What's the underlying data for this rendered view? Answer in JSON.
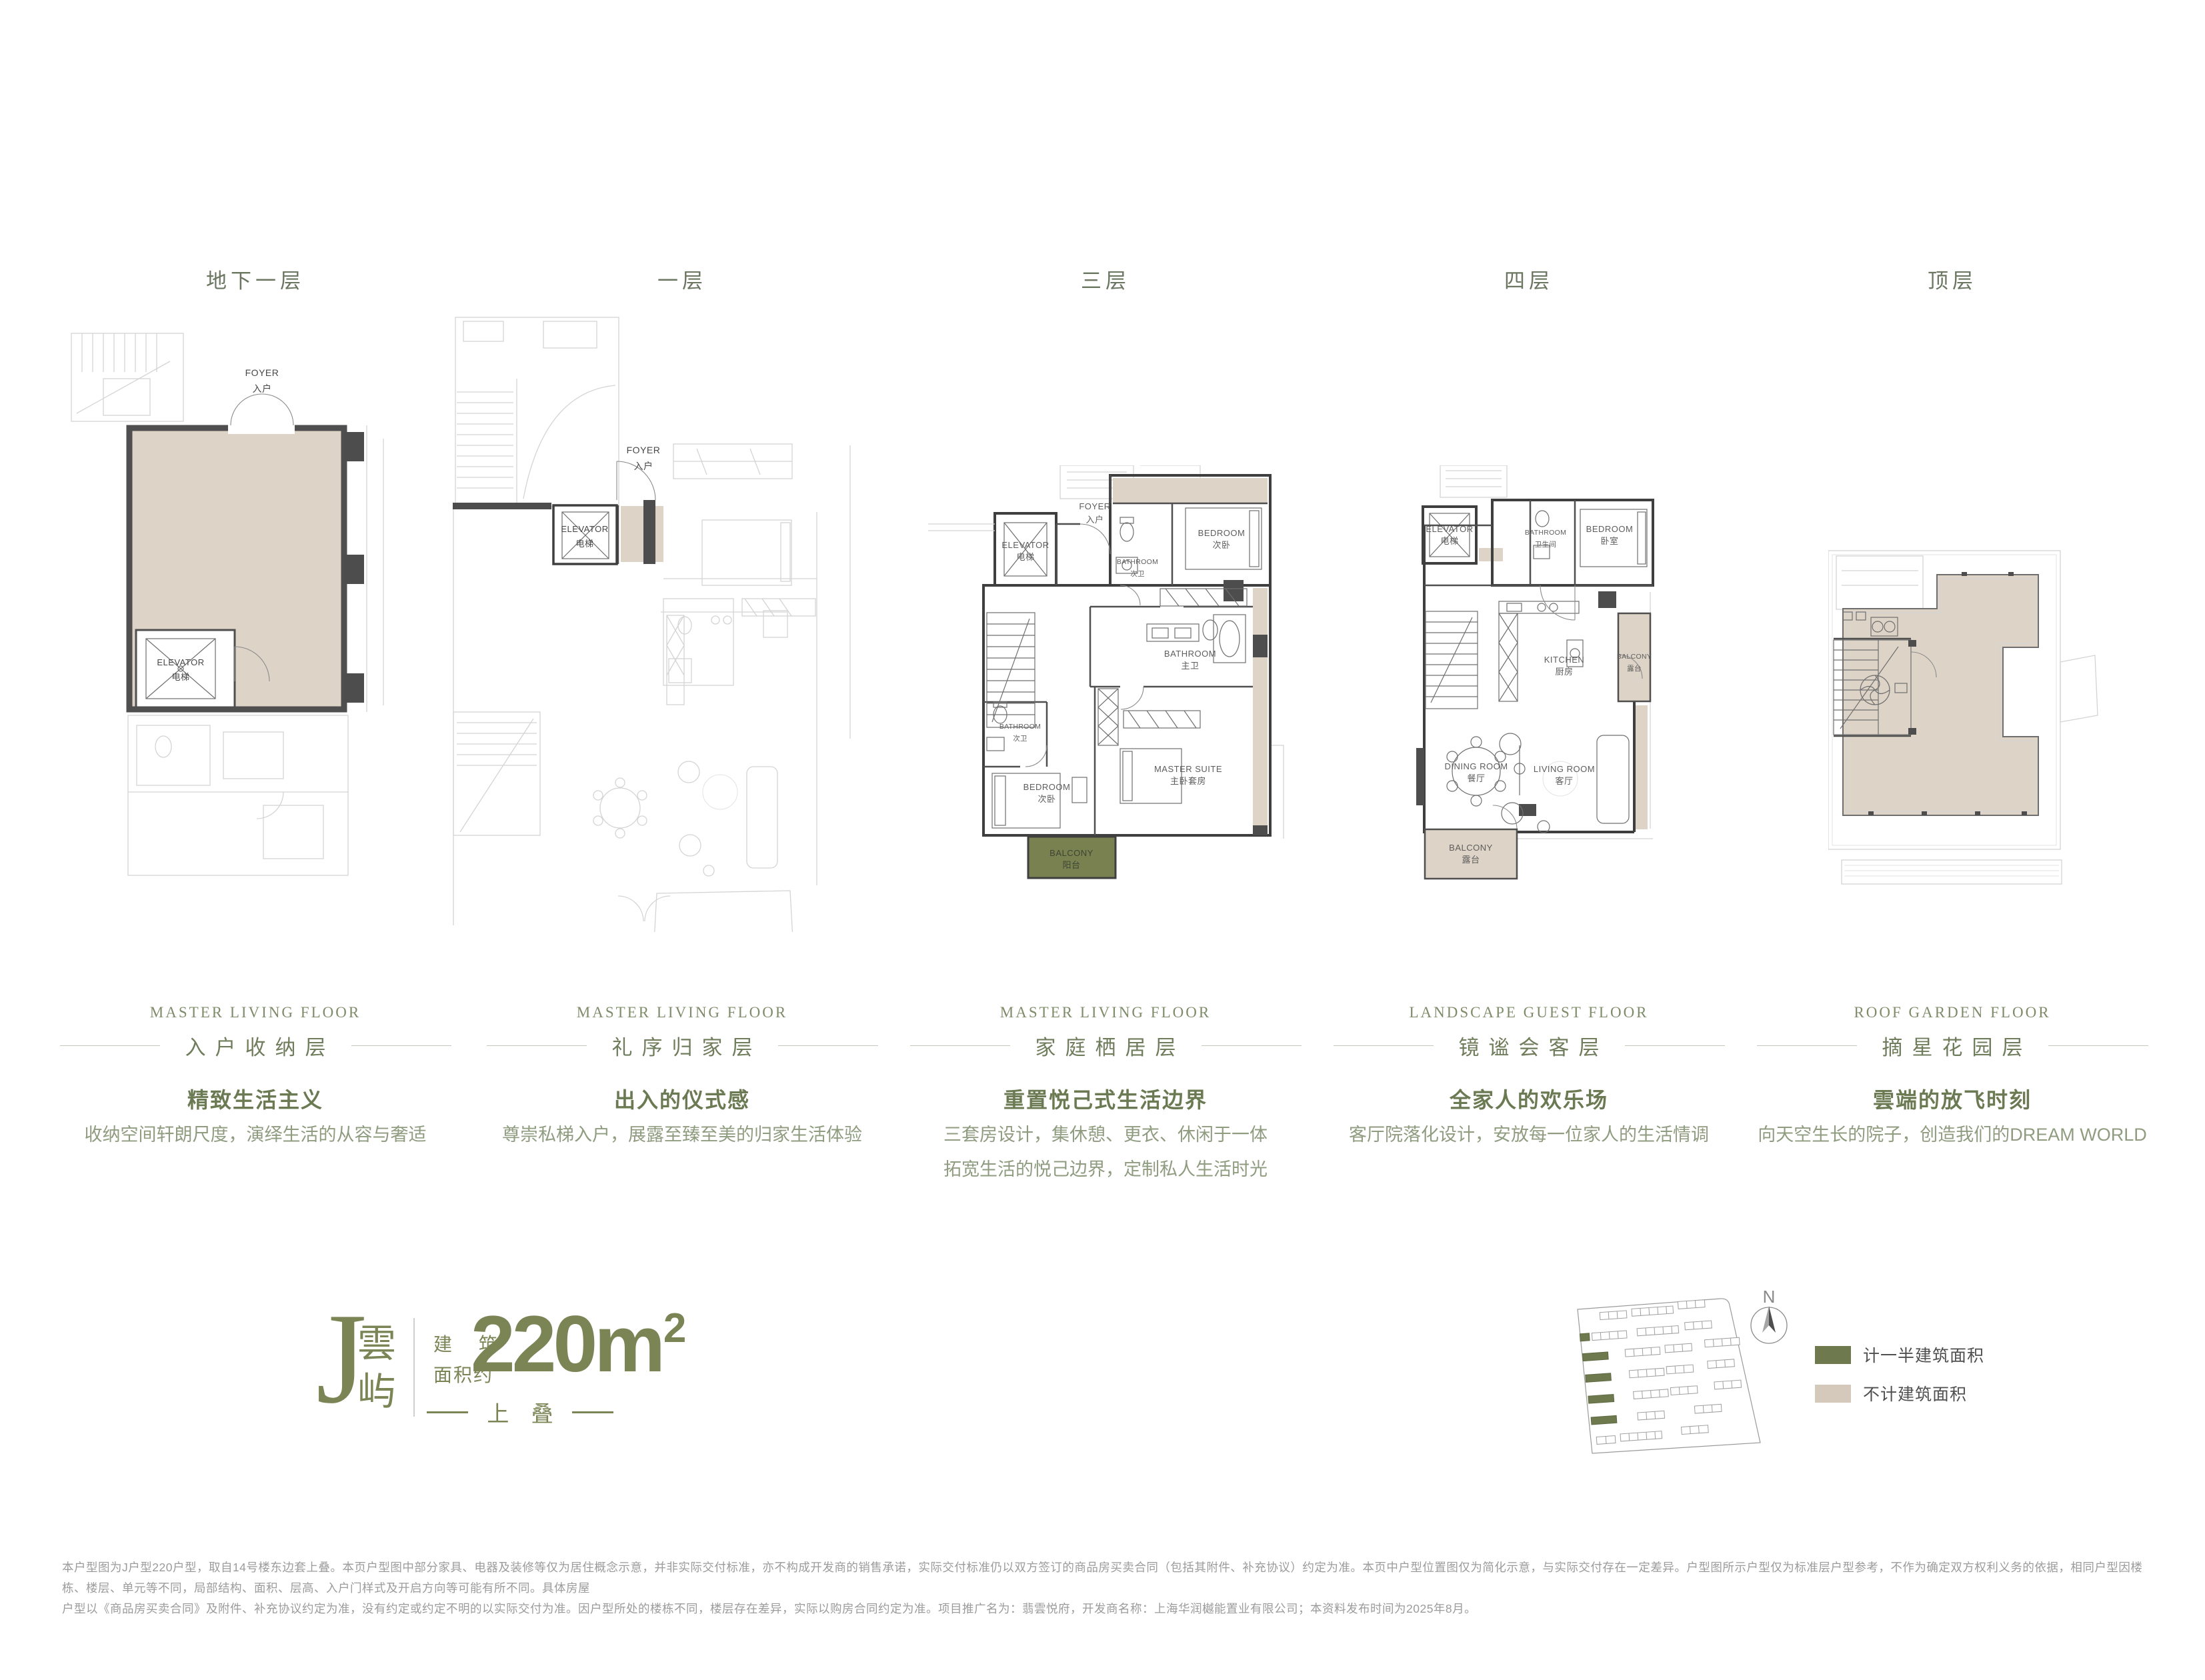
{
  "floors": [
    {
      "label": "地下一层",
      "english_title": "MASTER LIVING FLOOR",
      "chinese_title": "入户收纳层",
      "headline": "精致生活主义",
      "description": [
        "收纳空间轩朗尺度，演绎生活的从容与奢适"
      ]
    },
    {
      "label": "一层",
      "english_title": "MASTER LIVING FLOOR",
      "chinese_title": "礼序归家层",
      "headline": "出入的仪式感",
      "description": [
        "尊崇私梯入户，展露至臻至美的归家生活体验"
      ]
    },
    {
      "label": "三层",
      "english_title": "MASTER LIVING FLOOR",
      "chinese_title": "家庭栖居层",
      "headline": "重置悦己式生活边界",
      "description": [
        "三套房设计，集休憩、更衣、休闲于一体",
        "拓宽生活的悦己边界，定制私人生活时光"
      ]
    },
    {
      "label": "四层",
      "english_title": "LANDSCAPE GUEST FLOOR",
      "chinese_title": "镜谧会客层",
      "headline": "全家人的欢乐场",
      "description": [
        "客厅院落化设计，安放每一位家人的生活情调"
      ]
    },
    {
      "label": "顶层",
      "english_title": "ROOF GARDEN FLOOR",
      "chinese_title": "摘星花园层",
      "headline": "雲端的放飞时刻",
      "description": [
        "向天空生长的院子，创造我们的DREAM WORLD"
      ]
    }
  ],
  "plans": {
    "b1": {
      "foyer": "FOYER",
      "foyer_cn": "入户",
      "elevator": "ELEVATOR",
      "elevator_cn": "电梯"
    },
    "f1": {
      "foyer": "FOYER",
      "foyer_cn": "入户",
      "elevator": "ELEVATOR",
      "elevator_cn": "电梯"
    },
    "f3": {
      "elevator": "ELEVATOR",
      "elevator_cn": "电梯",
      "foyer": "FOYER",
      "foyer_cn": "入户",
      "bath_top": "BATHROOM",
      "bath_top_cn": "次卫",
      "bed_top": "BEDROOM",
      "bed_top_cn": "次卧",
      "bath_master": "BATHROOM",
      "bath_master_cn": "主卫",
      "bath_low": "BATHROOM",
      "bath_low_cn": "次卫",
      "bed_low": "BEDROOM",
      "bed_low_cn": "次卧",
      "master": "MASTER SUITE",
      "master_cn": "主卧套房",
      "balcony": "BALCONY",
      "balcony_cn": "阳台"
    },
    "f4": {
      "elevator": "ELEVATOR",
      "elevator_cn": "电梯",
      "bath": "BATHROOM",
      "bath_cn": "卫生间",
      "bed": "BEDROOM",
      "bed_cn": "卧室",
      "kitchen": "KITCHEN",
      "kitchen_cn": "厨房",
      "balcony_e": "BALCONY",
      "balcony_e_cn": "露台",
      "dining": "DINING ROOM",
      "dining_cn": "餐厅",
      "living": "LIVING ROOM",
      "living_cn": "客厅",
      "balcony_s": "BALCONY",
      "balcony_s_cn": "露台"
    }
  },
  "branding": {
    "letter": "J",
    "name_char1": "雲",
    "name_char2": "屿",
    "area_label_line1": "建 筑",
    "area_label_line2": "面积约",
    "area_value": "220m",
    "area_sup": "2",
    "tagline": "上 叠"
  },
  "legend": {
    "items": [
      {
        "label": "计一半建筑面积",
        "color": "#6e7a4e"
      },
      {
        "label": "不计建筑面积",
        "color": "#d5c9bc"
      }
    ]
  },
  "compass": {
    "label": "N"
  },
  "disclaimer": {
    "lines": [
      "本户型图为J户型220户型，取自14号楼东边套上叠。本页户型图中部分家具、电器及装修等仅为居住概念示意，并非实际交付标准，亦不构成开发商的销售承诺，实际交付标准仍以双方签订的商品房买卖合同（包括其附件、补充协议）约定为准。本页中户型位置图仅为简化示意，与实际交付存在一定差异。户型图所示户型仅为标准层户型参考，不作为确定双方权利义务的依据，相同户型因楼栋、楼层、单元等不同，局部结构、面积、层高、入户门样式及开启方向等可能有所不同。具体房屋",
      "户型以《商品房买卖合同》及附件、补充协议约定为准，没有约定或约定不明的以实际交付为准。因户型所处的楼栋不同，楼层存在差异，实际以购房合同约定为准。项目推广名为：翡雲悦府，开发商名称：上海华润樾能置业有限公司；本资料发布时间为2025年8月。"
    ]
  },
  "colors": {
    "accent_green": "#7b8455",
    "title_green": "#707d5c",
    "desc_green": "#8f9c80",
    "balcony_green": "#78814f",
    "area_beige": "#ddd3c7",
    "legend_green": "#6e7a4e",
    "legend_beige": "#d5c9bc",
    "wall_dark": "#4a4a4a",
    "disclaimer_gray": "#9b9b9b"
  }
}
